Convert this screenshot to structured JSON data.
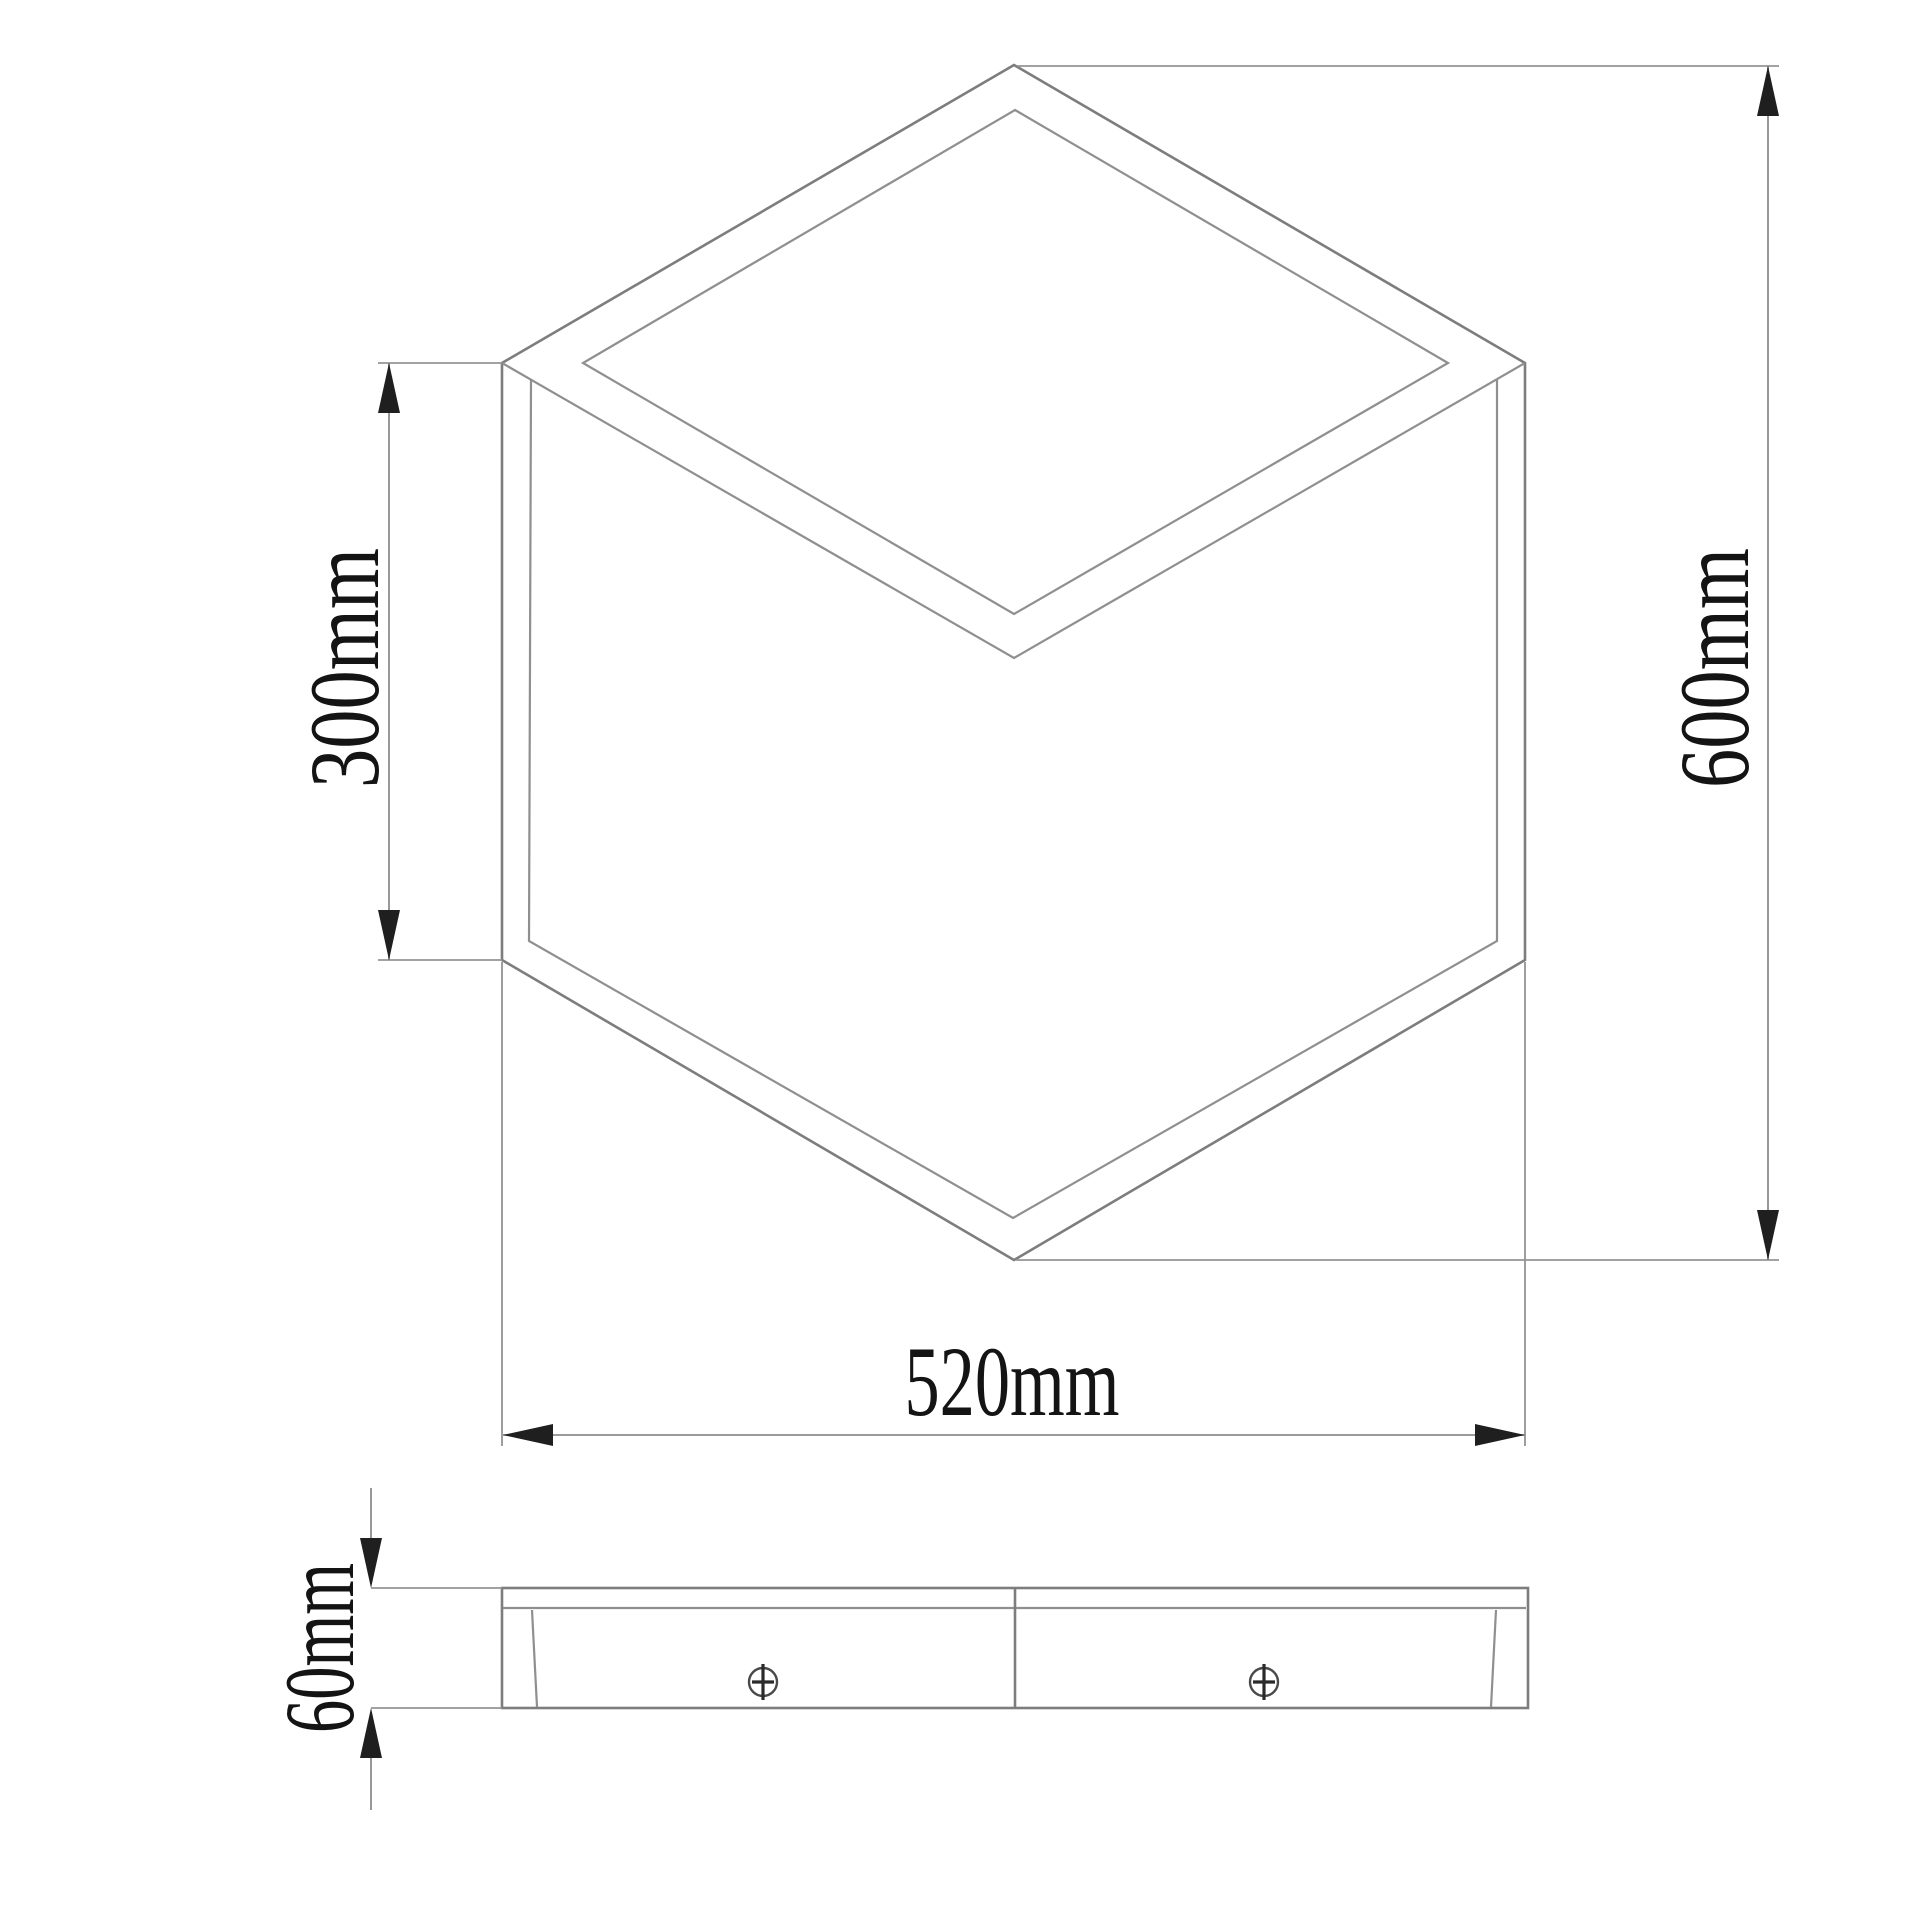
{
  "front_view": {
    "edge_height_dim": {
      "label": "300mm"
    },
    "total_height_dim": {
      "label": "600mm"
    },
    "width_dim": {
      "label": "520mm"
    }
  },
  "side_view": {
    "thickness_dim": {
      "label": "60mm"
    },
    "screw_count": 2
  },
  "colors": {
    "background": "#ffffff",
    "drawing_line": "#7d7d7d",
    "secondary_line": "#8f8f8f",
    "dimension_line": "#8c8c8c",
    "text": "#141414",
    "arrowhead": "#1f1f1f"
  }
}
